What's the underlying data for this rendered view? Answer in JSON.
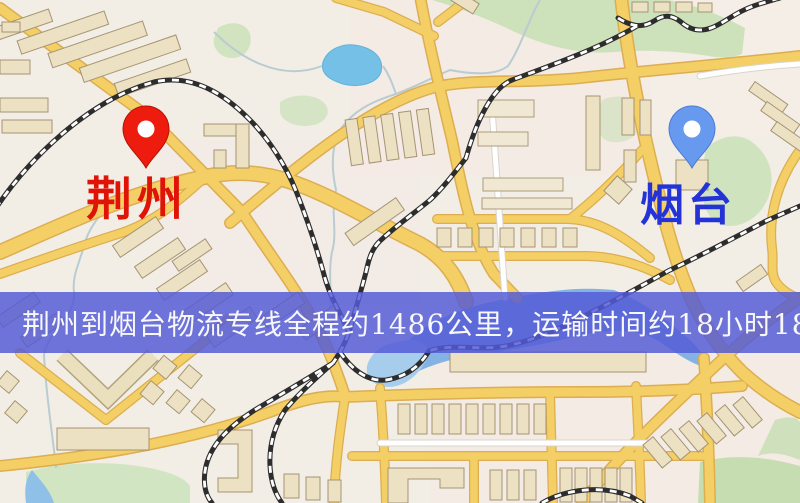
{
  "map": {
    "description_note": "road map with two city markers and a logistics route banner",
    "markers": [
      {
        "id": "jingzhou",
        "label": "荆州",
        "label_color": "#e01307",
        "pin_color": "#ee1c0e",
        "pin_style": "red-pin",
        "x": 146,
        "y": 142
      },
      {
        "id": "yantai",
        "label": "烟台",
        "label_color": "#2433d8",
        "pin_color": "#679aef",
        "pin_style": "blue-pin",
        "x": 692,
        "y": 142
      }
    ],
    "banner": {
      "text": "荆州到烟台物流专线全程约1486公里，运输时间约18小时18分钟.",
      "bg_color": "#545ad7",
      "text_color": "#f8f8fa"
    },
    "palette": {
      "background": "#f2eee6",
      "road_fill": "#f4cf66",
      "road_casing": "#ddad51",
      "building": "#ece1c3",
      "green_area": "#c9e0b6",
      "water": "#84b2e2",
      "lake": "#74c0e6",
      "railway": "#2d2d2d"
    }
  }
}
